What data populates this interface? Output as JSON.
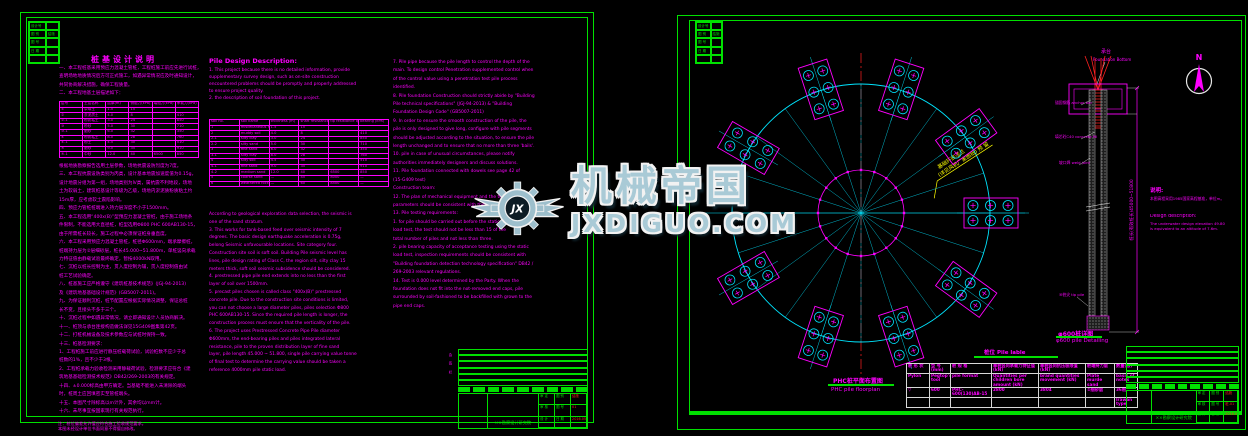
{
  "watermark": {
    "brand": "机械帝国",
    "domain": "JXDIGUO.COM",
    "monogram": "JX",
    "color": "#a9cad6"
  },
  "left_sheet": {
    "legend_rows": [
      [
        "设计号",
        ""
      ],
      [
        "图 别",
        "结施"
      ],
      [
        "图 号",
        ""
      ],
      [
        "日 期",
        ""
      ],
      [
        "",
        ""
      ]
    ],
    "cn": {
      "title": "桩基设计说明",
      "intro_lines": [
        "一、本工程桩基采用预应力混凝土管桩，工程桩施工前应先进行试桩，",
        "查明场地地质情况后方可正式施工，如遇异常情况应及时通知设计，",
        "共同协商解决措施，确保工程质量。",
        "二、本工程地基土层描述如下："
      ],
      "soil_table": {
        "headers": [
          "层号",
          "土层名称",
          "层厚(m)",
          "侧阻力(kPa)",
          "端阻力(kPa)",
          "承载力(kPa)"
        ],
        "rows": [
          [
            "①",
            "杂填土",
            "1.5",
            "15",
            "",
            ""
          ],
          [
            "②",
            "淤泥质土",
            "4.0",
            "8",
            "",
            "410"
          ],
          [
            "②-1",
            "粉质粘土",
            "3.0",
            "24",
            "",
            "850"
          ],
          [
            "③",
            "粉砂",
            "5.0",
            "30",
            "",
            "710"
          ],
          [
            "③-1",
            "细砂",
            "6.0",
            "32",
            "",
            "350"
          ],
          [
            "④",
            "粉质粘土",
            "8.0",
            "28",
            "",
            "760"
          ],
          [
            "④-1",
            "粉土",
            "4.5",
            "30",
            "",
            "510"
          ],
          [
            "⑤",
            "细砂",
            "9.0",
            "35",
            "",
            "910"
          ],
          [
            "⑤-1",
            "中砂",
            "12.0",
            "40",
            "6500",
            "850"
          ]
        ]
      },
      "body_lines": [
        "根据地质勘察报告选用土层参数，场地抗震设防烈度为7度。",
        "三、本工程抗震设防类别为丙类，设计基本地震加速度值为0.15g，",
        "设计地震分组为第一组，场地类别为Ⅳ类，属抗震不利地段，场地",
        "土为软弱土，建筑桩基设计等级为乙级，场地内淤泥质粉质粘土约",
        "15m厚，应考虑软土震陷影响。",
        "四、预应力管桩桩端进入持力层深度不小于1500mm。",
        "五、本工程选用“400x(B)”型预应力混凝土管桩，由于施工场地条",
        "件限制，不能选用大直径桩，桩型选用Φ800 PHC 600AB130-15，",
        "由于所需桩长较长，施工过程中必须保证桩身垂直度。",
        "六、本工程采用预应力混凝土管桩，桩径Φ600mm，端承摩擦桩，",
        "桩端持力层为②层细砂层，桩长45.000~51.800m，单桩竖向承载",
        "力特征值由静载试验最终确定，暂按4000kN取用。",
        "七、沉桩以桩长控制为主，贯入度控制为辅，贯入度控制值由试",
        "桩工艺试验确定。",
        "八、桩基施工应严格遵守《建筑桩基技术规范》(JGJ-94-2013)",
        "及《建筑地基基础设计规范》(GB5007-2011)。",
        "九、为保证顺利沉桩，桩节配置应根据实际情况调整，保证总桩",
        "长不变，且接头不多于三个。",
        "十、沉桩过程中如遇异常情况，请立即通知设计人员协商解决。",
        "十一、桩顶与承台连接构造做法详见15G409图集第42页。",
        "十二、打桩机械设备及技术参数应与试桩时保持一致。",
        "十三、桩基检测要求：",
        "1、工程桩施工前应进行静压桩载荷试验，试验桩数不应少于总",
        "桩数的1%，且不少于3根。",
        "2、工程桩承载力验收检测采用静载荷试验，检测要求应符合《建",
        "筑地基基础检测技术规范》DB42/269-2003的有关规定。",
        "十四、±0.000标高由甲方确定。当基础不能进入未清除的端头",
        "时，桩周土应回填密实至管桩端头。",
        "十五、本图尺寸除标高以m计外，其余均以mm计。",
        "十六、未尽事宜按国家现行有关规范执行。"
      ],
      "footer_lines": [
        "注：桩位偏差允许值应符合施工验收规范要求。",
        "本图未经设计单位书面同意不得擅自修改。"
      ]
    },
    "en": {
      "heading": "Pile Design Description:",
      "intro_lines": [
        "1. This project because there is no detailed information, provide",
        "supplementary survey design, such as on-site construction",
        "encountered problems should be promptly and properly addressed",
        "to ensure project quality.",
        "2. the description of soil foundation of this project."
      ],
      "soil_table": {
        "headers": [
          "soil no.",
          "soil name",
          "thickness (m)",
          "shaft resistance qsa(kPa)",
          "tip resistance qpa(kPa)",
          "bearing (kPa)"
        ],
        "rows": [
          [
            "1",
            "miscellaneous fill",
            "1.5",
            "15",
            "",
            ""
          ],
          [
            "2",
            "muddy soil",
            "4.0",
            "8",
            "",
            "410"
          ],
          [
            "2-1",
            "silty clay",
            "3.0",
            "24",
            "",
            "850"
          ],
          [
            "2-2",
            "silty sand",
            "5.0",
            "30",
            "",
            "710"
          ],
          [
            "3",
            "fine sand",
            "6.0",
            "32",
            "",
            "350"
          ],
          [
            "3-1",
            "silty clay",
            "8.0",
            "28",
            "",
            "760"
          ],
          [
            "4",
            "silty soil",
            "4.5",
            "30",
            "",
            "510"
          ],
          [
            "4-1",
            "fine sand",
            "9.0",
            "35",
            "",
            "910"
          ],
          [
            "4-2",
            "medium sand",
            "12.0",
            "40",
            "6500",
            "850"
          ],
          [
            "5",
            "coarse sand",
            "—",
            "45",
            "8000",
            "—"
          ],
          [
            "6",
            "weathered rock",
            "—",
            "60",
            "8500",
            "—"
          ]
        ]
      },
      "body_lines": [
        "According to geological exploration data selection, the seismic is",
        "one of the sand stratum.",
        "3. This works for tank-based feed over seismic intensity of 7",
        "degrees. The basic design earthquake acceleration is 0.75g,",
        "belong Seismic unfavourable locations. Site category four.",
        "Construction site soil is soft soil. Building Pile seismic level has",
        "lines, pile design rating of Class C, the region silt, silty clay 15",
        "meters thick, soft soil seismic subsidence should be considered.",
        "4. prestressed pipe pile end extends into no less than the first",
        "layer of soil over 1500mm.",
        "5. precast piles chosen is called class \"400x(B)\" prestressed",
        "concrete pile. Due to the construction site conditions is limited,",
        "you can not choose a large diameter piles, piles selection Φ800",
        "PHC 600AB130-15. Since the required pile length is longer, the",
        "construction process must ensure that the verticality of the pile.",
        "6. The project uses Prestressed Concrete Pipe Pile diameter",
        "Φ600mm, the end-bearing piles and piles integrated lateral",
        "resistance, pile to the proven distribution layer of fine sand",
        "layer, pile length 45.000 ~ 51.800, single pile carrying value tonne",
        "of final test to determine the carrying value should be taken a",
        "reference 4000mm pile static load."
      ]
    },
    "en2_lines": [
      "7. Pile pipe because the pile length to control the depth of the",
      "main. To design control Penetration supplemented control when",
      "of the control value using a penetration test pile process",
      "identified.",
      "8. Pile foundation Construction should strictly abide by \"Building",
      "Pile technical specifications\" (JGJ-94-2013) & \"Building",
      "Foundation Design Code\" (GB5007-2011)",
      "9. In order to ensure the smooth construction of the pile, the",
      "pile is only designed to give long, configure with pile segments",
      "should be adjusted according to the situation, to ensure the pile",
      "length unchanged and to ensure that no more than three 'bails'.",
      "10. pile in case of unusual circumstances, please notify",
      "authorities immediately designers and discuss solutions.",
      "11. Pile foundation connected with dowels see page 42 of",
      "(15-G409 text)",
      "Construction team:",
      "12. The plan of mechanical equipment and the technical",
      "parameters should be consistent with the test piles.",
      "13. Pile testing requirements:",
      "1. for pile should be carried out before the static pressure pile",
      "load test, the test should not be less than 15 of the",
      "total number of piles and not less than three.",
      "2. pile bearing capacity of acceptance testing using the static",
      "load test, inspection requirements should be consistent with",
      "\"Building foundation detection technology specification\" DB42 /",
      "269-2003 relevant regulations.",
      "14. Test is 0.000 level determined by the Party. When the",
      "foundation does not fit into the not-removed end caps, pile",
      "surrounded by soil-fashioned to be backfilled with grown to the",
      "pipe end caps."
    ],
    "titleblock": {
      "institute": "××勘察设计研究院",
      "rev_rows": [
        "",
        "",
        "",
        "",
        "",
        ""
      ],
      "blocks": [
        "",
        "",
        "",
        "",
        "",
        "",
        "",
        "",
        ""
      ],
      "fields": [
        [
          "审 定",
          "图 别",
          "结施"
        ],
        [
          "审 核",
          "图 号",
          "01"
        ],
        [
          "设 计",
          "日 期",
          "2016.05"
        ]
      ]
    },
    "sign_strip": "会 签 栏"
  },
  "right_sheet": {
    "legend_rows": [
      [
        "设计号",
        ""
      ],
      [
        "图 别",
        "结施"
      ],
      [
        "图 号",
        ""
      ],
      [
        "日 期",
        ""
      ],
      [
        "",
        ""
      ]
    ],
    "north_label": "N",
    "plan": {
      "annotation_line1": "基础环底法兰",
      "annotation_line2": "(详见风机厂家图纸) 预 留",
      "caption_cn": "PHC桩平面布置图",
      "caption_en": "PHC pile floorplan"
    },
    "detail": {
      "top_label_cn": "承台",
      "top_label_en": "Foundation Bottom",
      "label_anchor": "锚固钢筋 anchor bar",
      "label_fill": "填芯砼C40 concrete fill",
      "label_weld": "坡口焊 weld joint",
      "label_tip": "⑩桩尖 tip pile",
      "dim_text": "桩长(有效桩长)45000~51800",
      "caption_cn": "φ600桩详图",
      "caption_en": "φ600 pile Detailing"
    },
    "pile_table": {
      "title_cn": "桩位",
      "title_en": "Pile lable",
      "rows": [
        [
          "桩 形 状",
          "型 号(mm)",
          "桩 规 格",
          "单桩竖向承载力特征值(kN)",
          "单桩竖向抗压极限值(kN)",
          "桩端持力层",
          "数量(根)"
        ],
        [
          "Pylon",
          "Pegtop's tool",
          "pile format",
          "Quantities per children bore amount (kN)",
          "brand quantities movement (kN)",
          "Plate murde sand",
          "basis of notes"
        ],
        [
          "▽",
          "600",
          "PHC-600(130)AB-15",
          "2800",
          "3804",
          "②细砂层",
          "36根"
        ],
        [
          "",
          "",
          "",
          "",
          "",
          "",
          "Irawan type"
        ]
      ]
    },
    "design_note": {
      "title_cn": "说明:",
      "line_cn": "本图高程采用1985国家高程基准，单位m。",
      "title_en": "Design description:",
      "line_en1": "The underwater design elevation 49.80",
      "line_en2": "is equivalent to an altitude of 7.6m."
    },
    "titleblock": {
      "institute": "××勘察设计研究院",
      "rev_rows": [
        "",
        "",
        "",
        "",
        "",
        ""
      ],
      "blocks": [
        "",
        "",
        "",
        "",
        "",
        "",
        "",
        "",
        ""
      ],
      "fields": [
        [
          "审 定",
          "图 别",
          "结施"
        ],
        [
          "审 核",
          "图 号",
          "桩-01"
        ],
        [
          "设 计",
          "日 期",
          "2016.05"
        ]
      ]
    }
  }
}
